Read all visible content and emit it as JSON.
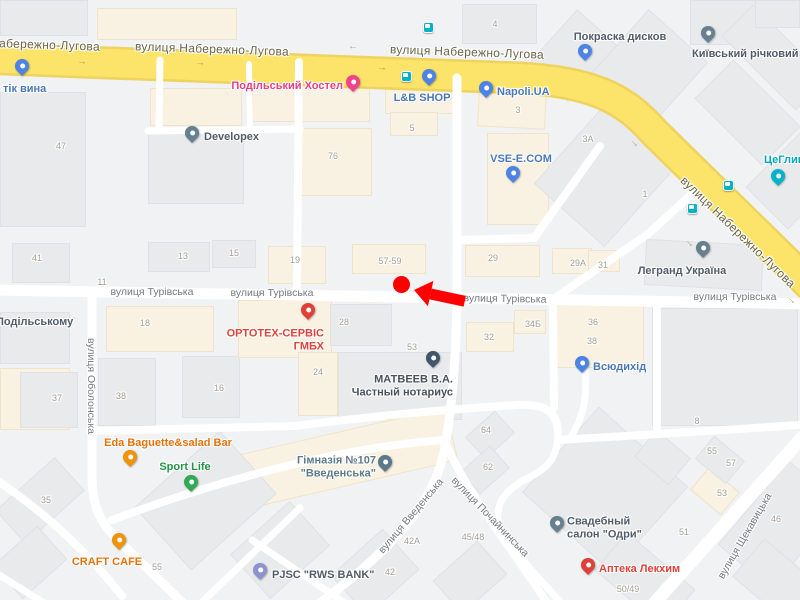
{
  "map": {
    "width": 800,
    "height": 600,
    "colors": {
      "background": "#f0f2f4",
      "road": "#ffffff",
      "highway_fill": "#fbe469",
      "highway_casing": "#eed35f",
      "building": "#e8eaec",
      "building_commercial": "#f9f1e1",
      "street_label": "#767b80",
      "highway_label": "#6b654a",
      "building_number": "#a6a096",
      "marker_red": "#ff0000",
      "transit_teal": "#00b3c7"
    },
    "highway_name": "вулиця Набережно-Лугова",
    "street_labels": [
      {
        "t": "вулиця Набережно-Лугова",
        "x": 100,
        "y": 44,
        "r": 2,
        "k": "hw",
        "align": "right"
      },
      {
        "t": "вулиця Набережно-Лугова",
        "x": 212,
        "y": 49,
        "r": 2,
        "k": "hw",
        "align": "center"
      },
      {
        "t": "вулиця Набережно-Лугова",
        "x": 467,
        "y": 52,
        "r": 2,
        "k": "hw",
        "align": "center"
      },
      {
        "t": "вулиця Набережно-Лугова",
        "x": 738,
        "y": 232,
        "r": 44,
        "k": "hw",
        "align": "center"
      },
      {
        "t": "вулиця Турівська",
        "x": 152,
        "y": 292,
        "r": 0,
        "k": "st",
        "align": "center"
      },
      {
        "t": "вулиця Турівська",
        "x": 272,
        "y": 293,
        "r": 0,
        "k": "st",
        "align": "center"
      },
      {
        "t": "вулиця Турівська",
        "x": 505,
        "y": 299,
        "r": 1,
        "k": "st",
        "align": "center"
      },
      {
        "t": "вулиця Турівська",
        "x": 735,
        "y": 297,
        "r": 0,
        "k": "st",
        "align": "center"
      },
      {
        "t": "вулиця Оболонська",
        "x": 91,
        "y": 386,
        "r": 90,
        "k": "st",
        "align": "center"
      },
      {
        "t": "вулиця Введенська",
        "x": 411,
        "y": 516,
        "r": -50,
        "k": "st",
        "align": "center"
      },
      {
        "t": "вулиця Почайнинська",
        "x": 490,
        "y": 517,
        "r": 46,
        "k": "st",
        "align": "center"
      },
      {
        "t": "вулиця Щекавицька",
        "x": 745,
        "y": 536,
        "r": -60,
        "k": "st",
        "align": "center"
      }
    ],
    "poi": [
      {
        "id": "butik-vyna",
        "lines": [
          "тік вина"
        ],
        "color": "blue",
        "lx": 3,
        "ly": 89,
        "align": "left",
        "pin": {
          "x": 22,
          "y": 68,
          "color": "blue"
        }
      },
      {
        "id": "podilskyi-hostel",
        "lines": [
          "Подільський Хостел"
        ],
        "color": "pink",
        "lx": 343,
        "ly": 86,
        "align": "right",
        "pin": {
          "x": 353,
          "y": 84,
          "color": "pink"
        }
      },
      {
        "id": "lb-shop",
        "lines": [
          "L&B SHOP"
        ],
        "color": "blue",
        "lx": 422,
        "ly": 98,
        "align": "center",
        "pin": {
          "x": 429,
          "y": 78,
          "color": "blue"
        }
      },
      {
        "id": "napoli-ua",
        "lines": [
          "Napoli.UA"
        ],
        "color": "blue",
        "lx": 497,
        "ly": 92,
        "align": "left",
        "pin": {
          "x": 486,
          "y": 90,
          "color": "blue"
        }
      },
      {
        "id": "pokraska-dyskiv",
        "lines": [
          "Покраска дисков"
        ],
        "color": "slate",
        "lx": 620,
        "ly": 37,
        "align": "center",
        "pin": {
          "x": 585,
          "y": 53,
          "color": "blue"
        }
      },
      {
        "id": "kyivskyi-richkovyi-port",
        "lines": [
          "Київський річковий по"
        ],
        "color": "slate",
        "lx": 692,
        "ly": 54,
        "align": "left",
        "pin": {
          "x": 708,
          "y": 35,
          "color": "gray"
        }
      },
      {
        "id": "tseglyna",
        "lines": [
          "ЦеГлин"
        ],
        "color": "teal",
        "lx": 764,
        "ly": 160,
        "align": "left",
        "pin": {
          "x": 778,
          "y": 178,
          "color": "teal"
        }
      },
      {
        "id": "developex",
        "lines": [
          "Developex"
        ],
        "color": "slate",
        "lx": 204,
        "ly": 137,
        "align": "left",
        "pin": {
          "x": 192,
          "y": 135,
          "color": "gray"
        }
      },
      {
        "id": "vse-e-com",
        "lines": [
          "VSE-E.COM"
        ],
        "color": "blue",
        "lx": 521,
        "ly": 159,
        "align": "center",
        "pin": {
          "x": 513,
          "y": 175,
          "color": "blue"
        }
      },
      {
        "id": "legrand-ukraina",
        "lines": [
          "Легранд Україна"
        ],
        "color": "slate",
        "lx": 682,
        "ly": 271,
        "align": "center",
        "pin": {
          "x": 703,
          "y": 250,
          "color": "gray"
        }
      },
      {
        "id": "ortoteh-servis-gmbh",
        "lines": [
          "ОРТОТЕХ-СЕРВІС",
          "ГМБХ"
        ],
        "color": "red",
        "lx": 324,
        "ly": 340,
        "align": "right",
        "pin": {
          "x": 308,
          "y": 312,
          "color": "red"
        }
      },
      {
        "id": "matveev-notarius",
        "lines": [
          "МАТВЕЕВ В.А.",
          "Частный нотариус"
        ],
        "color": "darkslate",
        "lx": 453,
        "ly": 386,
        "align": "right",
        "pin": {
          "x": 433,
          "y": 360,
          "color": "navy"
        }
      },
      {
        "id": "vsiudykhid",
        "lines": [
          "Всюдихід"
        ],
        "color": "blue",
        "lx": 593,
        "ly": 367,
        "align": "left",
        "pin": {
          "x": 582,
          "y": 365,
          "color": "blue"
        }
      },
      {
        "id": "eda-baguette-salad-bar",
        "lines": [
          "Eda Baguette&salad Bar"
        ],
        "color": "orange",
        "lx": 168,
        "ly": 443,
        "align": "center",
        "pin": {
          "x": 130,
          "y": 459,
          "color": "orange"
        }
      },
      {
        "id": "sport-life",
        "lines": [
          "Sport Life"
        ],
        "color": "green",
        "lx": 185,
        "ly": 467,
        "align": "center",
        "pin": {
          "x": 191,
          "y": 484,
          "color": "green"
        }
      },
      {
        "id": "craft-cafe",
        "lines": [
          "CRAFT CAFE"
        ],
        "color": "orange",
        "lx": 107,
        "ly": 562,
        "align": "center",
        "pin": {
          "x": 119,
          "y": 542,
          "color": "orange"
        }
      },
      {
        "id": "himnaziya-107-vvedenska",
        "lines": [
          "Гімназія №107",
          "\"Введенська\""
        ],
        "color": "school",
        "lx": 376,
        "ly": 467,
        "align": "right",
        "pin": {
          "x": 385,
          "y": 464,
          "color": "school"
        }
      },
      {
        "id": "pjsc-rws-bank",
        "lines": [
          "PJSC \"RWS BANK\""
        ],
        "color": "slate",
        "lx": 272,
        "ly": 575,
        "align": "left",
        "pin": {
          "x": 260,
          "y": 572,
          "color": "purple"
        }
      },
      {
        "id": "svadebnyi-salon-odri",
        "lines": [
          "Свадебный",
          "салон \"Одри\""
        ],
        "color": "slate",
        "lx": 567,
        "ly": 528,
        "align": "left",
        "pin": {
          "x": 557,
          "y": 525,
          "color": "gray"
        }
      },
      {
        "id": "apteka-lekhim",
        "lines": [
          "Аптека Лекхим"
        ],
        "color": "red",
        "lx": 599,
        "ly": 569,
        "align": "left",
        "pin": {
          "x": 588,
          "y": 567,
          "color": "red"
        }
      },
      {
        "id": "podilskomu",
        "lines": [
          "Подільському"
        ],
        "color": "slate",
        "lx": -4,
        "ly": 322,
        "align": "left",
        "pin": null
      }
    ],
    "building_numbers": [
      {
        "t": "47",
        "x": 61,
        "y": 146
      },
      {
        "t": "76",
        "x": 333,
        "y": 156
      },
      {
        "t": "4",
        "x": 495,
        "y": 24
      },
      {
        "t": "5",
        "x": 412,
        "y": 128
      },
      {
        "t": "3",
        "x": 518,
        "y": 110
      },
      {
        "t": "3А",
        "x": 588,
        "y": 139
      },
      {
        "t": "1",
        "x": 645,
        "y": 194
      },
      {
        "t": "29",
        "x": 493,
        "y": 258
      },
      {
        "t": "29А",
        "x": 578,
        "y": 263
      },
      {
        "t": "31",
        "x": 603,
        "y": 265
      },
      {
        "t": "57-59",
        "x": 390,
        "y": 261
      },
      {
        "t": "19",
        "x": 295,
        "y": 260
      },
      {
        "t": "41",
        "x": 37,
        "y": 258
      },
      {
        "t": "13",
        "x": 183,
        "y": 256
      },
      {
        "t": "15",
        "x": 234,
        "y": 253
      },
      {
        "t": "11",
        "x": 102,
        "y": 282
      },
      {
        "t": "18",
        "x": 145,
        "y": 323
      },
      {
        "t": "37",
        "x": 57,
        "y": 398
      },
      {
        "t": "38",
        "x": 121,
        "y": 396
      },
      {
        "t": "16",
        "x": 219,
        "y": 388
      },
      {
        "t": "24",
        "x": 318,
        "y": 372
      },
      {
        "t": "28",
        "x": 344,
        "y": 322
      },
      {
        "t": "53",
        "x": 412,
        "y": 347
      },
      {
        "t": "32",
        "x": 489,
        "y": 337
      },
      {
        "t": "34Б",
        "x": 533,
        "y": 324
      },
      {
        "t": "36",
        "x": 593,
        "y": 322
      },
      {
        "t": "38",
        "x": 592,
        "y": 341
      },
      {
        "t": "64",
        "x": 486,
        "y": 430
      },
      {
        "t": "62",
        "x": 488,
        "y": 467
      },
      {
        "t": "42А",
        "x": 412,
        "y": 541
      },
      {
        "t": "42",
        "x": 390,
        "y": 572
      },
      {
        "t": "45/48",
        "x": 473,
        "y": 537
      },
      {
        "t": "35",
        "x": 46,
        "y": 500
      },
      {
        "t": "55",
        "x": 157,
        "y": 567
      },
      {
        "t": "8",
        "x": 697,
        "y": 421
      },
      {
        "t": "55",
        "x": 712,
        "y": 451
      },
      {
        "t": "57",
        "x": 731,
        "y": 463
      },
      {
        "t": "53",
        "x": 722,
        "y": 493
      },
      {
        "t": "51",
        "x": 684,
        "y": 532
      },
      {
        "t": "46",
        "x": 776,
        "y": 519
      },
      {
        "t": "50/49",
        "x": 628,
        "y": 589
      }
    ],
    "transit_stops": [
      {
        "x": 406,
        "y": 76
      },
      {
        "x": 428,
        "y": 27
      },
      {
        "x": 692,
        "y": 208
      },
      {
        "x": 728,
        "y": 185
      }
    ],
    "road_arrows": [
      {
        "x": 82,
        "y": 62,
        "r": 0,
        "c": "y"
      },
      {
        "x": 200,
        "y": 63,
        "r": 0,
        "c": "y"
      },
      {
        "x": 353,
        "y": 48,
        "r": 180,
        "c": "y"
      },
      {
        "x": 382,
        "y": 68,
        "r": 0,
        "c": "y"
      },
      {
        "x": 258,
        "y": 293,
        "r": 0,
        "c": "w"
      },
      {
        "x": 635,
        "y": 143,
        "r": 46,
        "c": "y"
      },
      {
        "x": 690,
        "y": 243,
        "r": 46,
        "c": "y"
      },
      {
        "x": 792,
        "y": 300,
        "r": 46,
        "c": "y"
      }
    ],
    "buildings": [
      [
        0,
        0,
        88,
        36,
        "g",
        0
      ],
      [
        97,
        8,
        140,
        32,
        "c",
        0
      ],
      [
        462,
        4,
        75,
        40,
        "g",
        0
      ],
      [
        545,
        18,
        55,
        75,
        "g",
        42
      ],
      [
        610,
        25,
        80,
        85,
        "g",
        42
      ],
      [
        690,
        0,
        70,
        45,
        "g",
        0
      ],
      [
        722,
        35,
        105,
        45,
        "g",
        45
      ],
      [
        755,
        0,
        45,
        28,
        "g",
        0
      ],
      [
        0,
        92,
        86,
        135,
        "g",
        0
      ],
      [
        150,
        88,
        92,
        38,
        "c",
        0
      ],
      [
        148,
        132,
        96,
        72,
        "g",
        0
      ],
      [
        252,
        76,
        118,
        46,
        "c",
        0
      ],
      [
        300,
        128,
        72,
        68,
        "c",
        0
      ],
      [
        385,
        84,
        72,
        30,
        "c",
        0
      ],
      [
        390,
        112,
        48,
        24,
        "c",
        0
      ],
      [
        478,
        88,
        68,
        40,
        "c",
        3
      ],
      [
        487,
        133,
        62,
        92,
        "c",
        0
      ],
      [
        560,
        115,
        95,
        115,
        "g",
        42
      ],
      [
        700,
        85,
        95,
        55,
        "g",
        45
      ],
      [
        765,
        140,
        60,
        80,
        "g",
        45
      ],
      [
        12,
        243,
        58,
        40,
        "g",
        0
      ],
      [
        148,
        242,
        62,
        30,
        "g",
        0
      ],
      [
        212,
        240,
        44,
        28,
        "g",
        0
      ],
      [
        268,
        246,
        58,
        38,
        "c",
        0
      ],
      [
        352,
        244,
        74,
        30,
        "c",
        0
      ],
      [
        465,
        245,
        75,
        32,
        "c",
        0
      ],
      [
        552,
        248,
        40,
        26,
        "c",
        0
      ],
      [
        588,
        250,
        32,
        22,
        "c",
        0
      ],
      [
        645,
        242,
        118,
        46,
        "g",
        3
      ],
      [
        0,
        312,
        70,
        52,
        "g",
        0
      ],
      [
        0,
        368,
        70,
        62,
        "c",
        0
      ],
      [
        106,
        306,
        108,
        46,
        "c",
        0
      ],
      [
        20,
        372,
        58,
        56,
        "g",
        0
      ],
      [
        98,
        358,
        58,
        68,
        "g",
        0
      ],
      [
        182,
        356,
        58,
        62,
        "g",
        0
      ],
      [
        238,
        300,
        94,
        58,
        "c",
        0
      ],
      [
        298,
        352,
        40,
        64,
        "c",
        0
      ],
      [
        330,
        304,
        62,
        42,
        "g",
        0
      ],
      [
        338,
        352,
        124,
        68,
        "g",
        0
      ],
      [
        466,
        322,
        48,
        30,
        "c",
        0
      ],
      [
        514,
        310,
        32,
        24,
        "c",
        0
      ],
      [
        556,
        302,
        88,
        66,
        "c",
        0
      ],
      [
        652,
        308,
        146,
        118,
        "g",
        0
      ],
      [
        225,
        432,
        230,
        55,
        "c",
        -13
      ],
      [
        148,
        458,
        115,
        85,
        "g",
        -42
      ],
      [
        0,
        478,
        80,
        45,
        "g",
        -42
      ],
      [
        0,
        540,
        60,
        45,
        "g",
        -42
      ],
      [
        240,
        520,
        80,
        60,
        "g",
        -42
      ],
      [
        340,
        545,
        70,
        55,
        "g",
        -42
      ],
      [
        470,
        420,
        40,
        30,
        "g",
        -42
      ],
      [
        465,
        455,
        40,
        30,
        "g",
        -42
      ],
      [
        545,
        432,
        120,
        115,
        "g",
        42
      ],
      [
        695,
        476,
        40,
        30,
        "c",
        40
      ],
      [
        640,
        440,
        45,
        35,
        "g",
        40
      ],
      [
        700,
        445,
        40,
        30,
        "g",
        40
      ],
      [
        745,
        470,
        70,
        110,
        "g",
        40
      ],
      [
        600,
        555,
        90,
        50,
        "g",
        40
      ],
      [
        440,
        555,
        60,
        45,
        "g",
        -42
      ],
      [
        740,
        555,
        70,
        50,
        "g",
        40
      ]
    ],
    "marker": {
      "dot_x": 401,
      "dot_y": 284,
      "arrow_tip_x": 414,
      "arrow_tip_y": 290,
      "arrow_angle_deg": 12,
      "color": "#ff0000"
    }
  }
}
